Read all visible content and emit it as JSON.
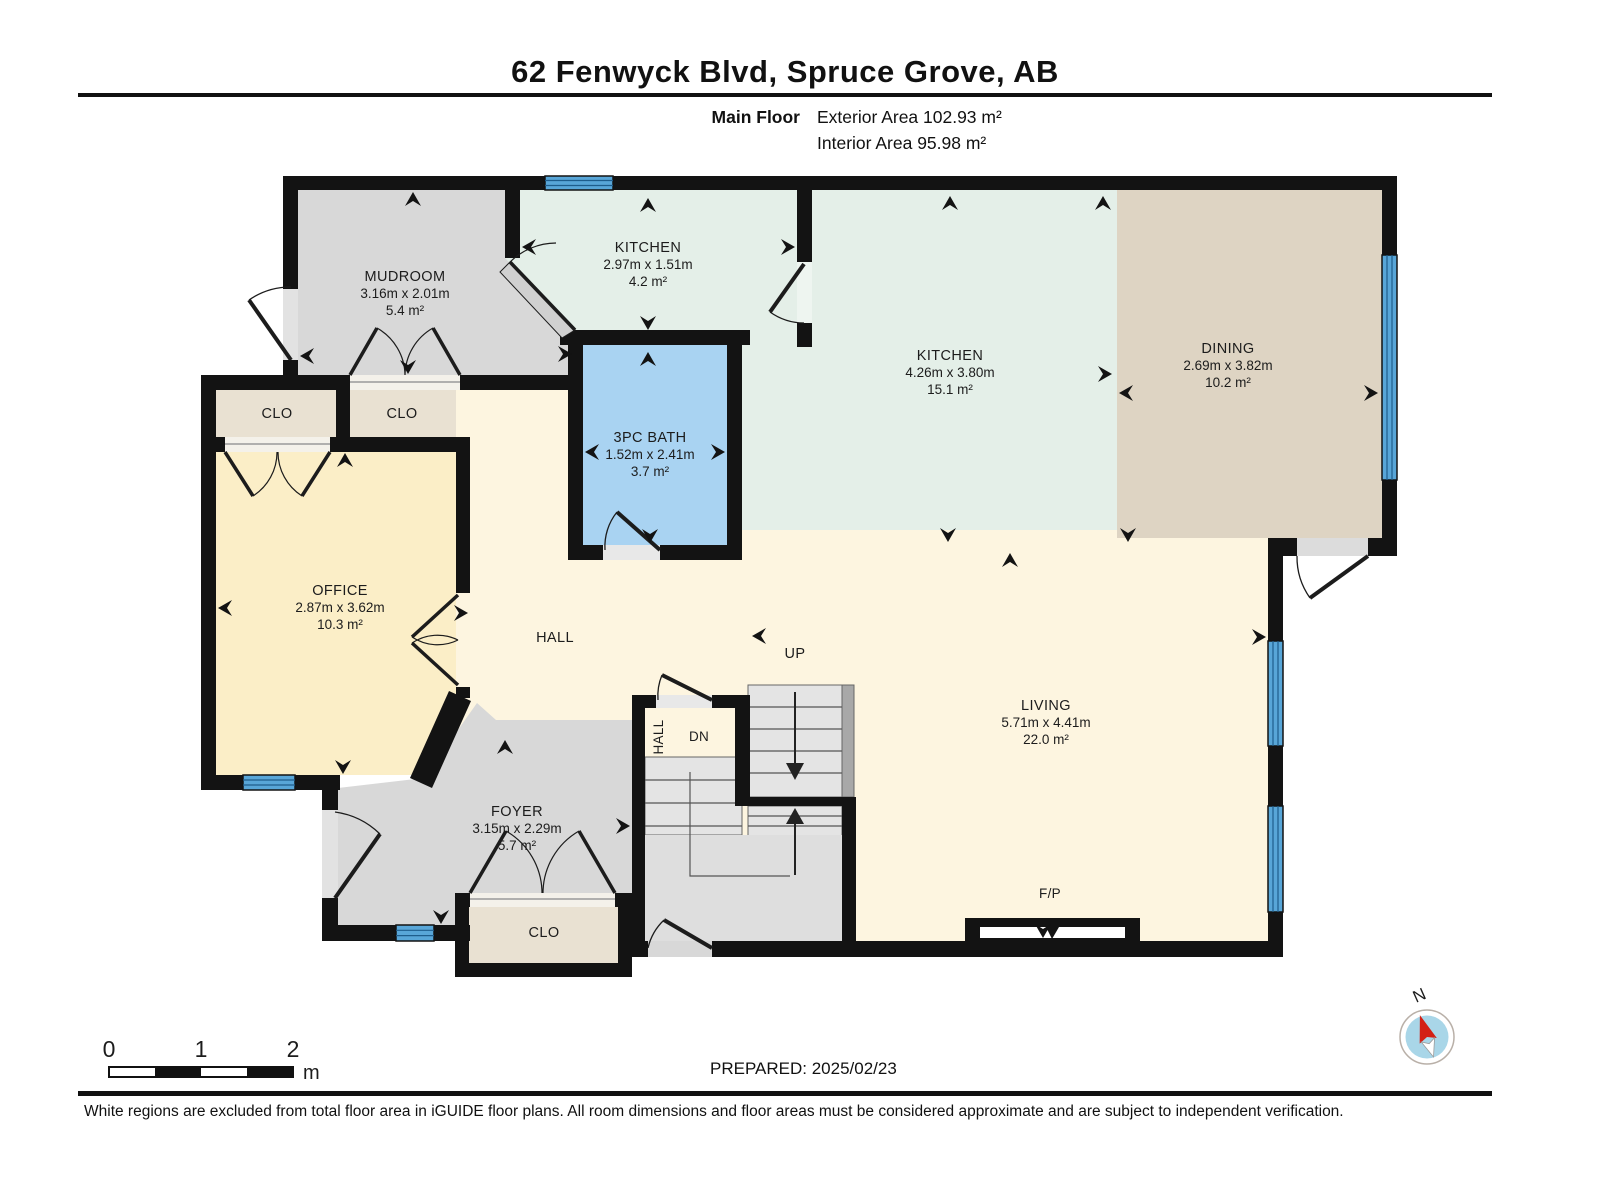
{
  "header": {
    "title": "62 Fenwyck Blvd, Spruce Grove, AB",
    "floor_label": "Main Floor",
    "exterior_area": "Exterior Area 102.93 m²",
    "interior_area": "Interior Area 95.98 m²"
  },
  "rooms": {
    "mudroom": {
      "name": "MUDROOM",
      "dims": "3.16m x 2.01m",
      "area": "5.4 m²"
    },
    "kitchen_small": {
      "name": "KITCHEN",
      "dims": "2.97m x 1.51m",
      "area": "4.2 m²"
    },
    "kitchen": {
      "name": "KITCHEN",
      "dims": "4.26m x 3.80m",
      "area": "15.1 m²"
    },
    "dining": {
      "name": "DINING",
      "dims": "2.69m x 3.82m",
      "area": "10.2 m²"
    },
    "bath": {
      "name": "3PC BATH",
      "dims": "1.52m x 2.41m",
      "area": "3.7 m²"
    },
    "office": {
      "name": "OFFICE",
      "dims": "2.87m x 3.62m",
      "area": "10.3 m²"
    },
    "living": {
      "name": "LIVING",
      "dims": "5.71m x 4.41m",
      "area": "22.0 m²"
    },
    "foyer": {
      "name": "FOYER",
      "dims": "3.15m x 2.29m",
      "area": "5.7 m²"
    }
  },
  "labels": {
    "hall": "HALL",
    "hall_stair": "HALL",
    "closet_left": "CLO",
    "closet_right": "CLO",
    "closet_foyer": "CLO",
    "up": "UP",
    "dn": "DN",
    "fireplace": "F/P"
  },
  "scale_bar": {
    "tick0": "0",
    "tick1": "1",
    "tick2": "2",
    "unit": "m"
  },
  "compass": {
    "north_label": "N"
  },
  "footer": {
    "prepared": "PREPARED: 2025/02/23",
    "disclaimer": "White regions are excluded from total floor area in iGUIDE floor plans. All room dimensions and floor areas must be considered approximate and are subject to independent verification."
  },
  "colors": {
    "wall": "#131313",
    "window": "#58a6d8",
    "room_gray": "#d8d8d8",
    "room_mint": "#e4efe8",
    "room_tan": "#ded4c3",
    "room_closet": "#e9e1d2",
    "room_blue": "#a9d3f2",
    "room_yellow": "#fbeec7",
    "room_cream": "#fdf5e0",
    "stairs": "#e4e4e4",
    "compass_blue": "#a9d6e8",
    "compass_red": "#d32015"
  }
}
